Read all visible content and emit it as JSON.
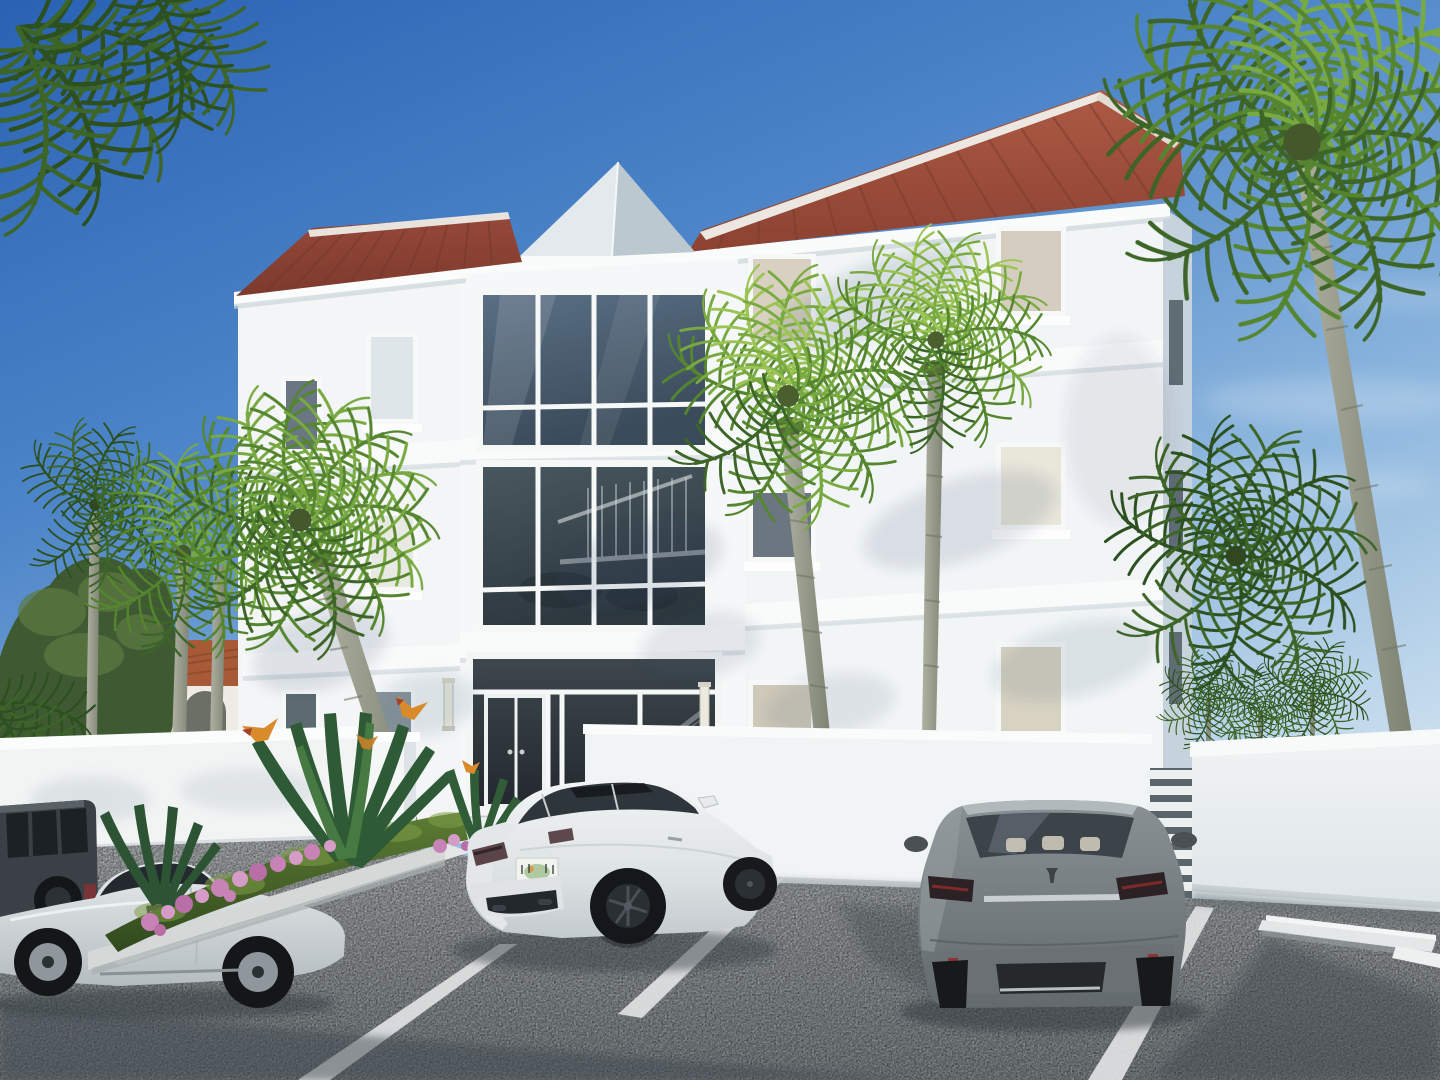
{
  "scene": {
    "title": "Coastal three-story white condominium building - 3D architectural rendering",
    "description": "Bright sunlit rendering of a white stucco three-story residential building with red standing-seam metal hip roofs and a gray pyramid skylight. A two-story glass curtain wall rises above a glazed entrance flanked by wall sconces. A white perimeter wall with a louvered slat section encloses the site. Royal palms surround the building and cast shadows on the facade. In front, a gray asphalt parking lot with white stripes holds a white sedan, a gray sedan, a silver sports car and a dark SUV. A planter bed with hedge, bird-of-paradise and pink flowers sits at left; a neighboring house with a terracotta tile roof shows behind the wall.",
    "sky": {
      "condition": "clear",
      "gradient_top": "#2a62b4",
      "gradient_horizon": "#d7e7f2",
      "clouds": "faint wisps at right"
    },
    "lighting": "afternoon sun from the left, palm shadows on facade and asphalt"
  },
  "building": {
    "stories": 3,
    "wall_color": "#f5f7f8",
    "shadow_face_color": "#c7d3dc",
    "roof": {
      "type": "standing-seam metal hip",
      "color": "#9d4f3c",
      "ridge_cap_color": "#ece7e0",
      "skylight": "gray pyramid"
    },
    "features": [
      "two-story glass curtain wall",
      "glazed entrance with dark tinted doors",
      "white floor bands",
      "white trimmed stucco windows",
      "vertical wall sconces",
      "interior stair visible through glass"
    ],
    "windows": {
      "trim_color": "#f7f9f9",
      "glass_dark": "#3c4f60",
      "glass_shade": "#d8d0c0"
    }
  },
  "site": {
    "perimeter_wall_color": "#f2f4f4",
    "louver_fence": "white horizontal slats",
    "parking": {
      "surface": "gray speckled asphalt",
      "stripe_color": "#e6e8e8",
      "wheel_stops": 2,
      "stalls_visible": 4
    },
    "planters": [
      "boxwood hedge",
      "bird of paradise",
      "pink flower cluster"
    ],
    "palm_count": 9
  },
  "vehicles": [
    {
      "type": "sedan",
      "color": "white",
      "view": "rear three-quarter",
      "position": "center stall",
      "license_plate": {
        "visible": true,
        "legible": false,
        "style": "white plate with green and orange state graphic"
      }
    },
    {
      "type": "sedan",
      "color": "gray",
      "view": "rear",
      "position": "right stall"
    },
    {
      "type": "sports car",
      "color": "silver",
      "view": "side",
      "position": "far left, partly out of frame"
    },
    {
      "type": "suv",
      "color": "dark gray",
      "view": "rear quarter",
      "position": "far left edge"
    }
  ],
  "neighborhood": {
    "left_background": "white house with terracotta tile roof and arched porch behind green trees"
  }
}
